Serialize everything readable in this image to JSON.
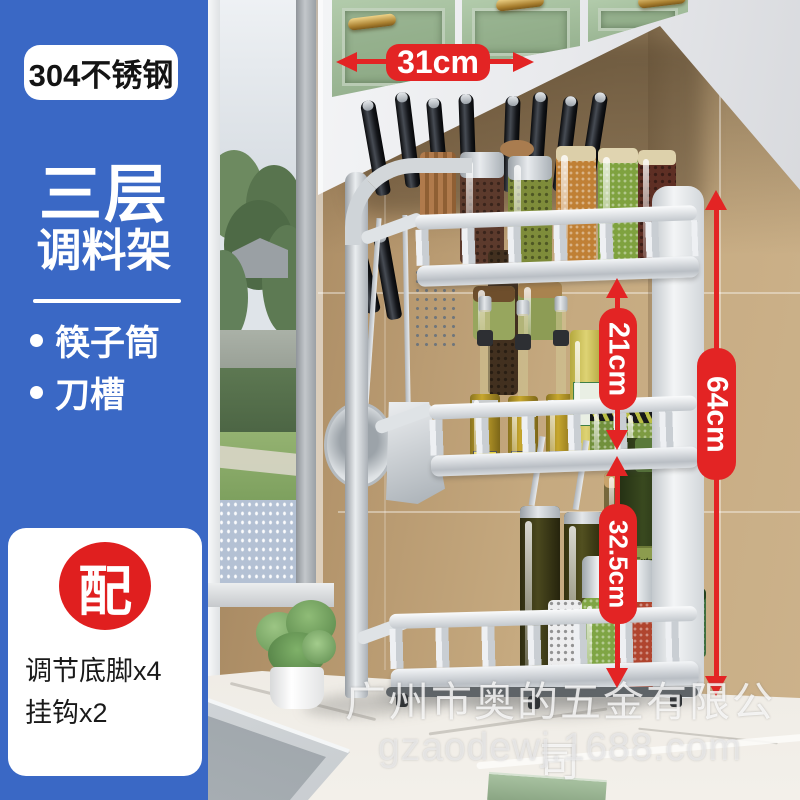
{
  "colors": {
    "sidebar_blue": "#3A68C5",
    "annotation_red": "#E32424",
    "badge_red": "#E01F1F",
    "cabinet_green": "#9DBB97",
    "wall_tan": "#C2A279"
  },
  "sidebar": {
    "material_badge": "304不锈钢",
    "title_line1": "三层",
    "title_line2": "调料架",
    "features": [
      "筷子筒",
      "刀槽"
    ],
    "accessory": {
      "badge": "配",
      "items": [
        "调节底脚x4",
        "挂钩x2"
      ]
    }
  },
  "dimensions": {
    "width_top": "31cm",
    "middle_tier": "21cm",
    "lower_section": "32.5cm",
    "total_height": "64cm"
  },
  "scene": {
    "oil_bottle_label": "Extra Virgin",
    "mini_bottle_label": "DE"
  },
  "watermark": {
    "company": "广州市奥的五金有限公司",
    "website": "gzaodewj.1688.com"
  }
}
